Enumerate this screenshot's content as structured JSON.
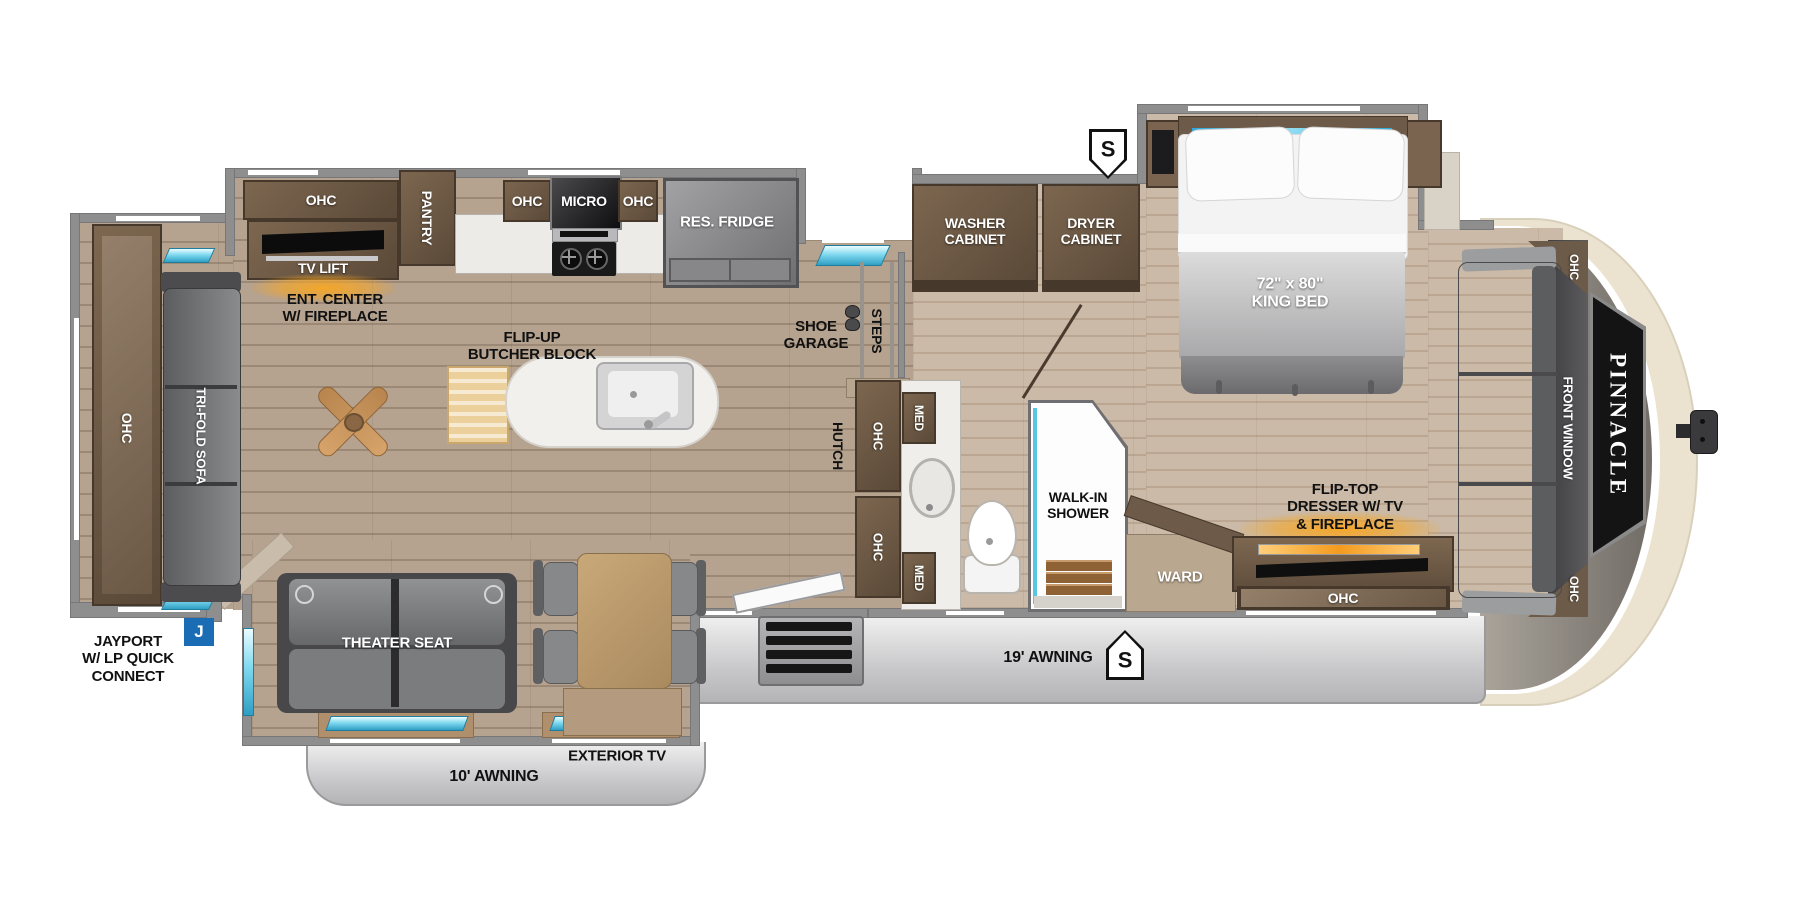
{
  "colors": {
    "wall_gray": "#8e8e8e",
    "floor_main_wood": "#b5a28f",
    "floor_bedroom_wood": "#cabaa7",
    "cabinet_brown": "#5f4d3c",
    "window_teal": "#5ecde6",
    "fireplace_orange": "#f5a623",
    "jayport_badge_blue": "#1a6cb5",
    "sidewall_gray": "#c6c6c8",
    "front_cap_cream": "#ebe2cf"
  },
  "rear_slide": {
    "ohc": "OHC",
    "sofa": "TRI-FOLD SOFA"
  },
  "ent_center": {
    "ohc": "OHC",
    "tv_lift": "TV LIFT",
    "caption1": "ENT. CENTER",
    "caption2": "W/ FIREPLACE"
  },
  "kitchen": {
    "pantry": "PANTRY",
    "ohc_left": "OHC",
    "micro": "MICRO",
    "ohc_right": "OHC",
    "fridge": "RES. FRIDGE",
    "island1": "FLIP-UP",
    "island2": "BUTCHER BLOCK"
  },
  "entry": {
    "shoe1": "SHOE",
    "shoe2": "GARAGE",
    "steps": "STEPS"
  },
  "laundry": {
    "washer1": "WASHER",
    "washer2": "CABINET",
    "dryer1": "DRYER",
    "dryer2": "CABINET"
  },
  "bedroom": {
    "bed1": "72\" x 80\"",
    "bed2": "KING BED",
    "ward": "WARD",
    "dresser1": "FLIP-TOP",
    "dresser2": "DRESSER W/ TV",
    "dresser3": "& FIREPLACE",
    "dresser_ohc": "OHC"
  },
  "bath": {
    "hutch": "HUTCH",
    "ohc_upper": "OHC",
    "ohc_lower": "OHC",
    "med_upper": "MED",
    "med_lower": "MED",
    "shower1": "WALK-IN",
    "shower2": "SHOWER"
  },
  "front": {
    "window": "FRONT WINDOW",
    "ohc_top": "OHC",
    "ohc_bottom": "OHC",
    "brand": "PINNACLE"
  },
  "living": {
    "theater": "THEATER SEAT"
  },
  "exterior": {
    "jayport1": "JAYPORT",
    "jayport2": "W/ LP QUICK",
    "jayport3": "CONNECT",
    "j_badge": "J",
    "awning_19": "19' AWNING",
    "awning_10": "10' AWNING",
    "exterior_tv": "EXTERIOR TV",
    "speaker_top": "S",
    "speaker_bottom": "S"
  }
}
